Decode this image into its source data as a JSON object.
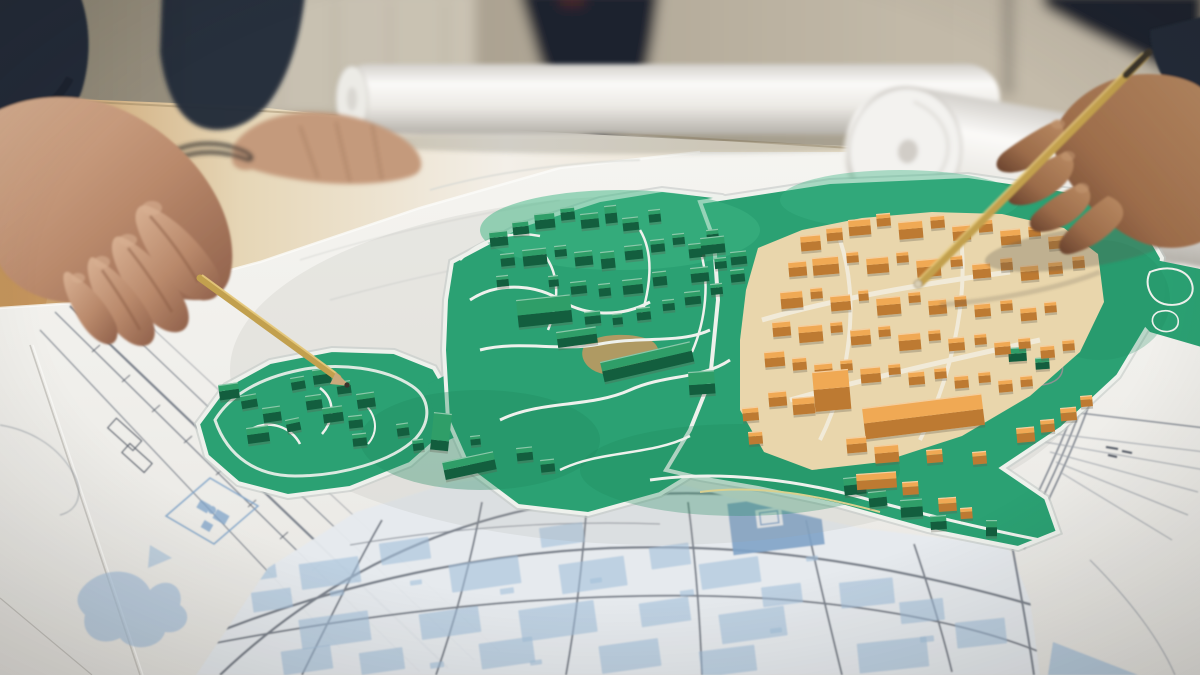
{
  "meta": {
    "aria_label": "Photograph of an urban planning meeting: hands pointing with pencils at a 3D city model with green and orange blocks placed on large blueprint map sheets on a table"
  },
  "palette": {
    "wall_left": "#87806f",
    "wall_mid": "#a89f8e",
    "wall_right": "#c6bdac",
    "wall_panel": "#cfc8b8",
    "door_frame": "#8f887b",
    "figure_dark": "#1e242e",
    "figure_dark2": "#2b303c",
    "accent_red": "#53282a",
    "table_wood": "#c3945c",
    "table_light": "#f3efe8",
    "table_tan": "#e0cba4",
    "paper": "#f0efeb",
    "paper_bright": "#fbfbf9",
    "paper_shade": "#dddcd8",
    "paper_edge": "#c6c4bf",
    "under_sheet": "#e8e6e2",
    "line_gray": "#7d838d",
    "line_light": "#9aa0a8",
    "line_dark": "#555b66",
    "sketch_faint": "#d9dad5",
    "blue_fill": "#a3bfda",
    "blue_dense": "#7fa3c8",
    "grid_paper": "#e6eaee",
    "green_base": "#2ba173",
    "green_dark": "#1f8a5e",
    "green_deep": "#14654a",
    "green_light": "#3db584",
    "path_white": "#eef1ec",
    "path_yellow": "#d9d08f",
    "tan_patch": "#c79960",
    "orange_floor": "#e9d6ac",
    "orange_road": "#f1ead8",
    "green_top": "#2f9e68",
    "green_front": "#135e3e",
    "orange_top": "#f0a954",
    "orange_front": "#bd7a32",
    "orange_light": "#f6c27a",
    "skin_l_hi": "#d8b092",
    "skin_l_mid": "#b9896b",
    "skin_l_sh": "#8a5c44",
    "skin_r_hi": "#c59a74",
    "skin_r_mid": "#9c6c4a",
    "skin_r_sh": "#66402c",
    "skin_rest": "#c49a7c",
    "sleeve": "#232a38",
    "sleeve_dark": "#181d28",
    "shirt": "#9aa7b5",
    "pencil_gold": "#c2a04e",
    "pencil_hi": "#e5c97c",
    "pencil_tip": "#3b342c",
    "pencil_end": "#d8cdb2",
    "roll_hi": "#fbfaf8",
    "roll_mid": "#ecebe6",
    "roll_sh": "#c2beb7",
    "roll_core": "#d5d2cc",
    "shadow": "#5f594d",
    "glasses": "#3a3632"
  },
  "objects": [
    {
      "name": "urban-planning-model",
      "description": "3D maquette with green and orange building blocks on a green site plan"
    },
    {
      "name": "blueprint-map",
      "description": "large printed site plans with blue technical drawings and street grid"
    },
    {
      "name": "left-hand-pointing",
      "description": "hand pointing at the green blocks with a yellow pencil"
    },
    {
      "name": "right-hand-pencil",
      "description": "hand holding an inverted pencil over the orange district"
    },
    {
      "name": "resting-hand",
      "description": "hand of a standing person resting on the table"
    },
    {
      "name": "paper-rolls",
      "description": "two rolled-up drawings at the top of the table"
    },
    {
      "name": "glasses",
      "description": "folded eyeglasses lying on the table"
    }
  ],
  "model": {
    "green_blocks": [
      [
        218,
        385,
        20,
        11,
        9,
        -8
      ],
      [
        240,
        396,
        16,
        9,
        8,
        -10
      ],
      [
        262,
        408,
        18,
        10,
        9,
        -8
      ],
      [
        285,
        420,
        14,
        8,
        8,
        -12
      ],
      [
        305,
        396,
        16,
        9,
        9,
        -8
      ],
      [
        322,
        408,
        20,
        11,
        9,
        -8
      ],
      [
        348,
        416,
        14,
        8,
        8,
        -6
      ],
      [
        290,
        378,
        14,
        8,
        8,
        -10
      ],
      [
        312,
        370,
        18,
        10,
        9,
        -8
      ],
      [
        336,
        382,
        14,
        8,
        8,
        -8
      ],
      [
        356,
        394,
        18,
        10,
        9,
        -8
      ],
      [
        246,
        428,
        22,
        12,
        9,
        -8
      ],
      [
        352,
        434,
        14,
        8,
        8,
        -6
      ],
      [
        396,
        424,
        12,
        8,
        8,
        -8
      ],
      [
        412,
        440,
        11,
        7,
        7,
        -8
      ],
      [
        489,
        232,
        18,
        10,
        9,
        -6
      ],
      [
        512,
        222,
        16,
        9,
        8,
        -6
      ],
      [
        534,
        214,
        20,
        11,
        9,
        -6
      ],
      [
        560,
        208,
        14,
        8,
        8,
        -6
      ],
      [
        580,
        214,
        18,
        10,
        9,
        -6
      ],
      [
        604,
        206,
        12,
        13,
        10,
        -6
      ],
      [
        622,
        218,
        16,
        9,
        8,
        -6
      ],
      [
        648,
        210,
        12,
        8,
        8,
        -6
      ],
      [
        500,
        254,
        14,
        8,
        8,
        -6
      ],
      [
        522,
        250,
        24,
        11,
        10,
        -6
      ],
      [
        554,
        246,
        12,
        7,
        7,
        -6
      ],
      [
        574,
        252,
        18,
        9,
        9,
        -6
      ],
      [
        600,
        252,
        14,
        12,
        10,
        -6
      ],
      [
        624,
        246,
        18,
        9,
        9,
        -6
      ],
      [
        650,
        240,
        14,
        8,
        8,
        -6
      ],
      [
        672,
        234,
        12,
        7,
        7,
        -6
      ],
      [
        496,
        276,
        12,
        7,
        7,
        -6
      ],
      [
        548,
        276,
        10,
        7,
        7,
        -6
      ],
      [
        570,
        282,
        16,
        8,
        8,
        -6
      ],
      [
        598,
        284,
        12,
        8,
        8,
        -6
      ],
      [
        622,
        280,
        20,
        10,
        9,
        -6
      ],
      [
        652,
        272,
        14,
        9,
        9,
        -6
      ],
      [
        688,
        244,
        16,
        9,
        9,
        -6
      ],
      [
        706,
        230,
        12,
        8,
        8,
        -6
      ],
      [
        690,
        268,
        18,
        10,
        9,
        -6
      ],
      [
        714,
        258,
        12,
        7,
        7,
        -6
      ],
      [
        516,
        300,
        54,
        26,
        12,
        -6
      ],
      [
        584,
        312,
        16,
        8,
        8,
        -6
      ],
      [
        612,
        314,
        10,
        7,
        7,
        -6
      ],
      [
        636,
        308,
        14,
        8,
        8,
        -6
      ],
      [
        662,
        300,
        12,
        7,
        7,
        -6
      ],
      [
        684,
        292,
        16,
        9,
        8,
        -6
      ],
      [
        710,
        284,
        12,
        7,
        7,
        -6
      ],
      [
        730,
        270,
        14,
        8,
        8,
        -6
      ],
      [
        600,
        362,
        92,
        16,
        11,
        -13
      ],
      [
        434,
        412,
        18,
        46,
        10,
        6
      ],
      [
        442,
        462,
        52,
        14,
        10,
        -12
      ],
      [
        688,
        372,
        26,
        22,
        10,
        -4
      ],
      [
        556,
        332,
        40,
        12,
        9,
        -8
      ],
      [
        516,
        448,
        16,
        9,
        8,
        -6
      ],
      [
        540,
        460,
        14,
        8,
        8,
        -6
      ],
      [
        470,
        436,
        10,
        6,
        6,
        -6
      ],
      [
        700,
        238,
        24,
        13,
        9,
        -6
      ],
      [
        730,
        252,
        16,
        9,
        8,
        -6
      ],
      [
        843,
        478,
        22,
        13,
        10,
        -6
      ],
      [
        868,
        492,
        18,
        11,
        9,
        -6
      ],
      [
        900,
        500,
        22,
        13,
        10,
        -4
      ],
      [
        930,
        516,
        16,
        10,
        8,
        -4
      ],
      [
        986,
        520,
        11,
        12,
        9,
        0
      ],
      [
        1008,
        348,
        18,
        10,
        8,
        -4
      ],
      [
        1035,
        358,
        14,
        8,
        7,
        -4
      ]
    ],
    "orange_blocks": [
      [
        800,
        236,
        20,
        11,
        9,
        -5
      ],
      [
        826,
        228,
        16,
        9,
        8,
        -5
      ],
      [
        848,
        220,
        22,
        12,
        9,
        -5
      ],
      [
        876,
        214,
        14,
        8,
        8,
        -5
      ],
      [
        898,
        222,
        24,
        13,
        10,
        -5
      ],
      [
        930,
        216,
        14,
        8,
        8,
        -5
      ],
      [
        952,
        226,
        18,
        10,
        9,
        -5
      ],
      [
        978,
        220,
        14,
        8,
        8,
        -5
      ],
      [
        1000,
        230,
        20,
        11,
        9,
        -5
      ],
      [
        1028,
        226,
        12,
        7,
        7,
        -5
      ],
      [
        1048,
        236,
        16,
        9,
        8,
        -5
      ],
      [
        788,
        262,
        18,
        10,
        9,
        -5
      ],
      [
        812,
        258,
        26,
        13,
        10,
        -5
      ],
      [
        846,
        252,
        12,
        7,
        7,
        -5
      ],
      [
        866,
        258,
        22,
        12,
        9,
        -5
      ],
      [
        896,
        252,
        12,
        7,
        7,
        -5
      ],
      [
        916,
        260,
        24,
        13,
        10,
        -5
      ],
      [
        950,
        256,
        12,
        7,
        7,
        -5
      ],
      [
        972,
        264,
        18,
        10,
        9,
        -5
      ],
      [
        1000,
        258,
        12,
        8,
        8,
        -5
      ],
      [
        1020,
        266,
        18,
        10,
        9,
        -5
      ],
      [
        1048,
        262,
        14,
        8,
        8,
        -5
      ],
      [
        1072,
        256,
        12,
        8,
        8,
        -5
      ],
      [
        780,
        292,
        22,
        12,
        10,
        -5
      ],
      [
        810,
        288,
        12,
        7,
        7,
        -5
      ],
      [
        830,
        296,
        20,
        11,
        9,
        -5
      ],
      [
        858,
        290,
        10,
        7,
        7,
        -5
      ],
      [
        876,
        298,
        24,
        13,
        10,
        -5
      ],
      [
        908,
        292,
        12,
        7,
        7,
        -5
      ],
      [
        928,
        300,
        18,
        10,
        9,
        -5
      ],
      [
        954,
        296,
        12,
        7,
        7,
        -5
      ],
      [
        974,
        304,
        16,
        9,
        8,
        -5
      ],
      [
        1000,
        300,
        12,
        7,
        7,
        -5
      ],
      [
        1020,
        308,
        16,
        9,
        8,
        -5
      ],
      [
        1044,
        302,
        12,
        7,
        7,
        -5
      ],
      [
        772,
        322,
        18,
        10,
        9,
        -5
      ],
      [
        798,
        326,
        24,
        12,
        10,
        -5
      ],
      [
        830,
        322,
        12,
        7,
        7,
        -5
      ],
      [
        850,
        330,
        20,
        11,
        9,
        -5
      ],
      [
        878,
        326,
        12,
        7,
        7,
        -5
      ],
      [
        898,
        334,
        22,
        12,
        10,
        -5
      ],
      [
        928,
        330,
        12,
        7,
        7,
        -5
      ],
      [
        948,
        338,
        16,
        9,
        8,
        -5
      ],
      [
        974,
        334,
        12,
        7,
        7,
        -5
      ],
      [
        994,
        342,
        16,
        9,
        8,
        -5
      ],
      [
        1018,
        338,
        12,
        7,
        7,
        -5
      ],
      [
        1040,
        346,
        14,
        8,
        8,
        -5
      ],
      [
        1062,
        340,
        12,
        7,
        7,
        -5
      ],
      [
        764,
        352,
        20,
        11,
        9,
        -5
      ],
      [
        792,
        358,
        14,
        8,
        8,
        -5
      ],
      [
        814,
        364,
        18,
        10,
        9,
        -5
      ],
      [
        840,
        360,
        12,
        7,
        7,
        -5
      ],
      [
        860,
        368,
        20,
        11,
        9,
        -5
      ],
      [
        888,
        364,
        12,
        7,
        7,
        -5
      ],
      [
        908,
        372,
        16,
        9,
        8,
        -5
      ],
      [
        934,
        368,
        12,
        7,
        7,
        -5
      ],
      [
        954,
        376,
        14,
        8,
        8,
        -5
      ],
      [
        978,
        372,
        12,
        7,
        7,
        -5
      ],
      [
        998,
        380,
        14,
        8,
        8,
        -5
      ],
      [
        1020,
        376,
        12,
        7,
        7,
        -5
      ],
      [
        812,
        372,
        36,
        30,
        22,
        -5
      ],
      [
        862,
        408,
        120,
        26,
        16,
        -7
      ],
      [
        768,
        392,
        18,
        10,
        9,
        -5
      ],
      [
        792,
        398,
        22,
        12,
        10,
        -5
      ],
      [
        846,
        438,
        20,
        11,
        9,
        -5
      ],
      [
        874,
        446,
        24,
        13,
        10,
        -5
      ],
      [
        926,
        450,
        16,
        9,
        8,
        -5
      ],
      [
        972,
        452,
        14,
        8,
        8,
        -5
      ],
      [
        1016,
        428,
        18,
        10,
        9,
        -5
      ],
      [
        1040,
        420,
        14,
        8,
        8,
        -5
      ],
      [
        1060,
        408,
        16,
        9,
        8,
        -5
      ],
      [
        1080,
        396,
        12,
        7,
        7,
        -5
      ],
      [
        856,
        474,
        40,
        12,
        9,
        -4
      ],
      [
        902,
        482,
        16,
        9,
        8,
        -4
      ],
      [
        938,
        498,
        18,
        10,
        8,
        -4
      ],
      [
        960,
        508,
        12,
        7,
        7,
        -4
      ],
      [
        742,
        408,
        16,
        9,
        8,
        -5
      ],
      [
        748,
        432,
        14,
        8,
        8,
        -5
      ]
    ],
    "blue_blocks": [
      [
        300,
        560,
        60,
        26,
        -8
      ],
      [
        380,
        540,
        50,
        22,
        -8
      ],
      [
        450,
        560,
        70,
        28,
        -8
      ],
      [
        540,
        525,
        44,
        20,
        -8
      ],
      [
        560,
        560,
        66,
        30,
        -8
      ],
      [
        650,
        545,
        40,
        22,
        -8
      ],
      [
        700,
        560,
        60,
        26,
        -8
      ],
      [
        300,
        615,
        70,
        30,
        -8
      ],
      [
        420,
        610,
        60,
        26,
        -8
      ],
      [
        520,
        605,
        76,
        32,
        -8
      ],
      [
        640,
        600,
        50,
        24,
        -8
      ],
      [
        720,
        610,
        66,
        30,
        -8
      ],
      [
        252,
        590,
        40,
        20,
        -8
      ],
      [
        840,
        580,
        54,
        26,
        -6
      ],
      [
        900,
        600,
        44,
        22,
        -6
      ],
      [
        956,
        620,
        50,
        26,
        -6
      ],
      [
        858,
        640,
        70,
        30,
        -6
      ],
      [
        480,
        640,
        54,
        26,
        -8
      ],
      [
        600,
        642,
        60,
        28,
        -8
      ],
      [
        360,
        650,
        44,
        22,
        -8
      ],
      [
        240,
        562,
        36,
        18,
        -8
      ],
      [
        762,
        585,
        40,
        20,
        -7
      ],
      [
        282,
        648,
        50,
        24,
        -8
      ],
      [
        700,
        648,
        56,
        26,
        -7
      ],
      [
        330,
        590,
        14,
        6,
        -8
      ],
      [
        410,
        580,
        12,
        5,
        -8
      ],
      [
        500,
        588,
        14,
        6,
        -8
      ],
      [
        590,
        578,
        12,
        5,
        -8
      ],
      [
        680,
        590,
        14,
        6,
        -8
      ],
      [
        770,
        628,
        12,
        5,
        -7
      ],
      [
        920,
        636,
        14,
        6,
        -6
      ],
      [
        806,
        556,
        12,
        5,
        -7
      ],
      [
        430,
        662,
        14,
        6,
        -8
      ],
      [
        530,
        660,
        12,
        5,
        -8
      ]
    ]
  }
}
